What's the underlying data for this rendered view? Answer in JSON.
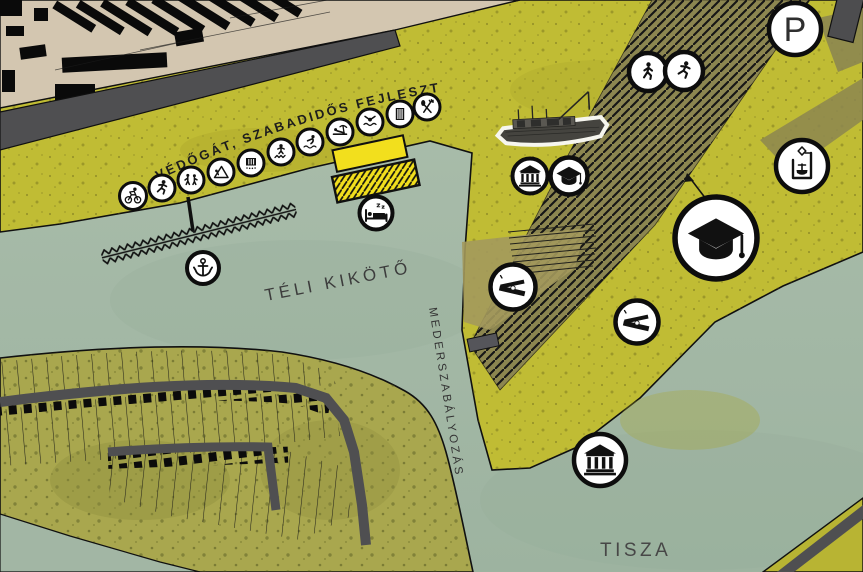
{
  "map": {
    "labels": {
      "dam_development": "VÉDŐGÁT, SZABADIDŐS FEJLESZTÉS",
      "winter_harbor": "TÉLI KIKÖTŐ",
      "riverbed_regulation": "MEDERSZABÁLYOZÁS",
      "river": "TISZA",
      "parking": "P"
    },
    "colors": {
      "water": "#a7bba9",
      "embankment_yellow": "#c0bc34",
      "development_band_olive": "#8c8650",
      "town_tan": "#d3c6b0",
      "road_gray": "#4f4f51",
      "barge_yellow": "#f2df1d",
      "marker_bg": "#ffffff",
      "marker_fg": "#111111"
    },
    "icons": {
      "dam_promenade": [
        "cycling-icon",
        "running-icon",
        "outdoor-fitness-icon",
        "climbing-frame-icon",
        "event-container-icon",
        "trampoline-icon",
        "water-jump-icon",
        "beach-rest-icon",
        "swimming-icon",
        "container-pavilion-icon",
        "restaurant-icon"
      ],
      "harbor": [
        "anchor-icon",
        "hotel-boat-bed-icon"
      ],
      "island": [
        "museum-icon",
        "education-cap-icon",
        "slipway-icon",
        "slipway-icon",
        "education-hub-cap-icon",
        "boat-lift-icon",
        "museum-icon",
        "walking-icon",
        "running-icon",
        "parking-icon"
      ],
      "illustration": [
        "historic-ship-photo"
      ]
    }
  }
}
